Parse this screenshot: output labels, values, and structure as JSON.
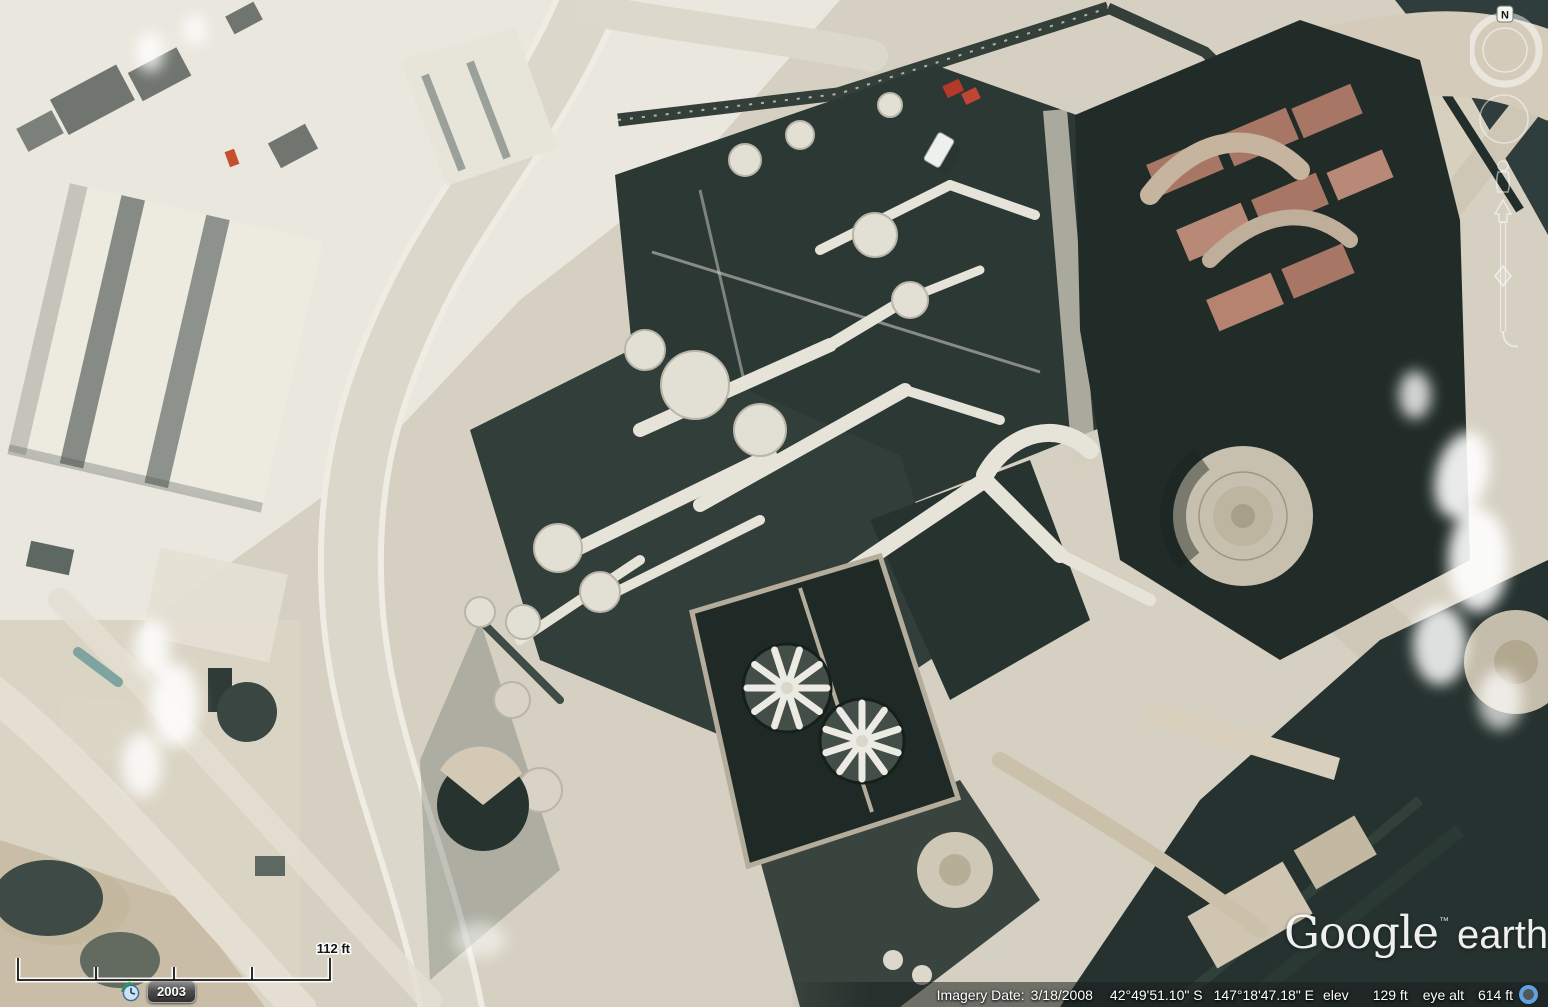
{
  "map": {
    "scale_bar": {
      "label": "112 ft"
    },
    "time_control": {
      "year": "2003",
      "icon": "historical-imagery-clock"
    },
    "navigation": {
      "north_label": "N"
    },
    "watermark": {
      "brand": "Google",
      "trademark": "™",
      "product": "earth"
    },
    "status_bar": {
      "imagery_date_label": "Imagery Date:",
      "imagery_date": "3/18/2008",
      "latitude": "42°49'51.10\" S",
      "longitude": "147°18'47.18\" E",
      "elevation_label": "elev",
      "elevation": "129 ft",
      "eye_altitude_label": "eye alt",
      "eye_altitude": "614 ft"
    },
    "colors": {
      "streaming_ring": "#63a0e0",
      "status_text": "#ffffff",
      "time_button_background": "#4e4e4e"
    }
  }
}
